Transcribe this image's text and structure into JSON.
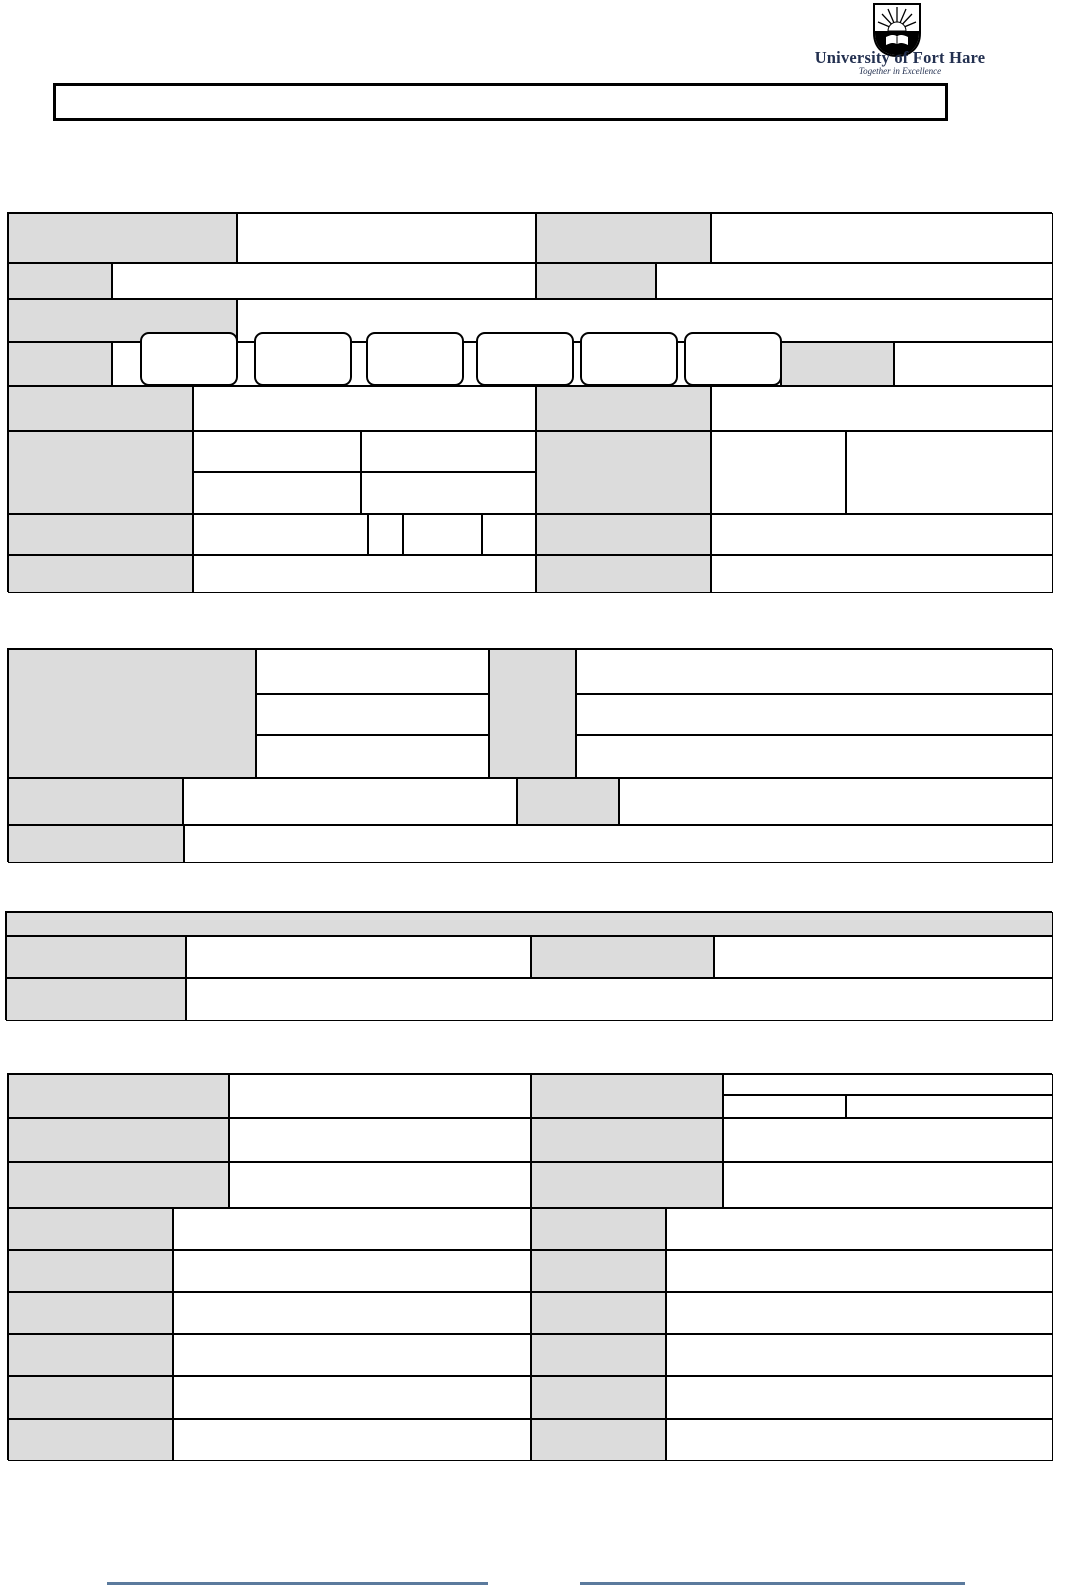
{
  "logo": {
    "institution": "University of Fort Hare",
    "tagline": "Together in Excellence",
    "crest_icon": "ufh-crest: shield with rising sun rays over an open book"
  },
  "title_box": {
    "text": ""
  },
  "theme": {
    "label_cell_fill": "#dcdcdc",
    "border_color": "#000000",
    "logo_text_color": "#233050",
    "signature_line_color": "#5b7a9d",
    "page_background": "#ffffff"
  },
  "form": {
    "state": "blank",
    "section1": {
      "rows": 8,
      "entry_boxes": [
        "",
        "",
        "",
        "",
        "",
        ""
      ],
      "field_values": [
        "",
        "",
        "",
        "",
        "",
        "",
        "",
        "",
        "",
        "",
        "",
        "",
        "",
        "",
        "",
        "",
        "",
        ""
      ]
    },
    "section2": {
      "rows": 5,
      "field_values": [
        "",
        "",
        "",
        "",
        "",
        "",
        "",
        "",
        ""
      ]
    },
    "section3": {
      "header": "",
      "rows": 3,
      "field_values": [
        "",
        "",
        ""
      ]
    },
    "section4": {
      "rows": 9,
      "field_values": [
        "",
        "",
        "",
        "",
        "",
        "",
        "",
        "",
        "",
        "",
        "",
        "",
        ""
      ]
    }
  },
  "footer": {
    "signature_line_left": "",
    "signature_line_right": ""
  }
}
